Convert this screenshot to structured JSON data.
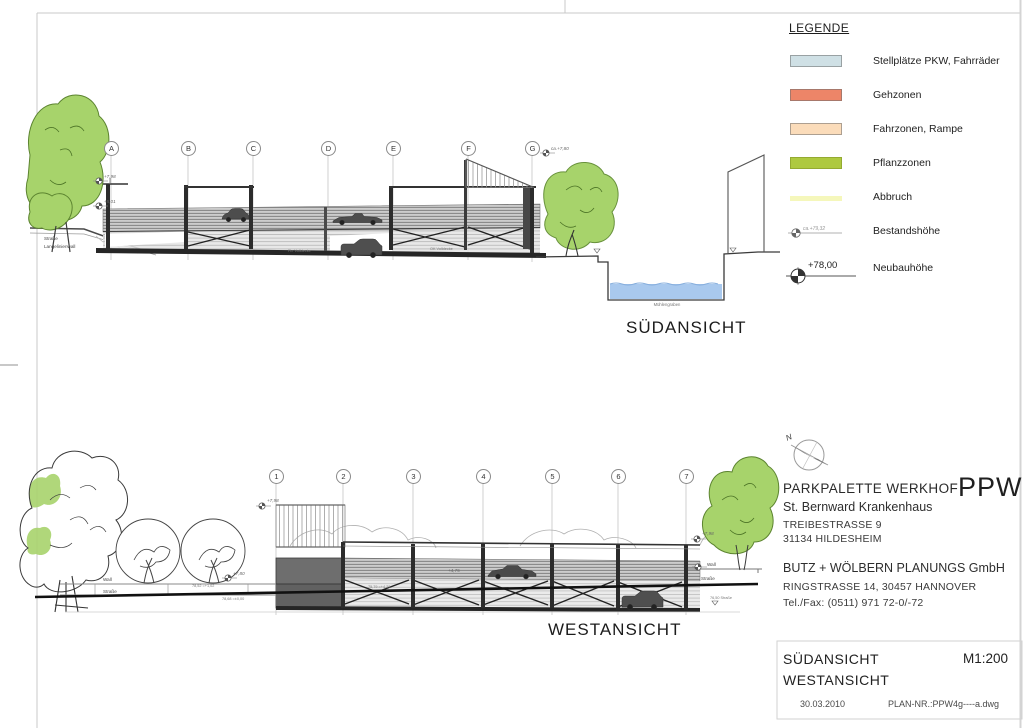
{
  "legend": {
    "title": "LEGENDE",
    "items": [
      {
        "label": "Stellplätze PKW, Fahrräder",
        "color": "#cfe0e5"
      },
      {
        "label": "Gehzonen",
        "color": "#ed8568"
      },
      {
        "label": "Fahrzonen, Rampe",
        "color": "#fbdcba"
      },
      {
        "label": "Pflanzzonen",
        "color": "#aec93f"
      },
      {
        "label": "Abbruch",
        "color": "#f5f7bb"
      },
      {
        "label": "Bestandshöhe",
        "value": "ca.+79,32"
      },
      {
        "label": "Neubauhöhe",
        "value": "+78,00"
      }
    ]
  },
  "titleblock": {
    "north_label": "N",
    "project": "PARKPALETTE WERKHOF",
    "logo": "PPW",
    "client": "St. Bernward Krankenhaus",
    "client_street": "TREIBESTRASSE 9",
    "client_city": "31134 HILDESHEIM",
    "planner": "BUTZ + WÖLBERN PLANUNGS GmbH",
    "planner_street": "RINGSTRASSE 14, 30457 HANNOVER",
    "planner_phone": "Tel./Fax: (0511) 971 72-0/-72",
    "sheet_view1": "SÜDANSICHT",
    "sheet_view2": "WESTANSICHT",
    "scale": "M1:200",
    "date": "30.03.2010",
    "plan_no": "PLAN-NR.:PPW4g----a.dwg"
  },
  "sued": {
    "view_label": "SÜDANSICHT",
    "grid": [
      "A",
      "B",
      "C",
      "D",
      "E",
      "F",
      "G"
    ],
    "road_line1": "Straße",
    "road_line2": "Langelinienwall",
    "water_label": "Mühlengraben",
    "marks": {
      "a_top": "+7,98",
      "a_mid": "+5,01",
      "g_top": "ca.+7,80",
      "note1": "Fb. Volldecke",
      "note2": "OK Volldecke"
    }
  },
  "west": {
    "view_label": "WESTANSICHT",
    "grid": [
      "1",
      "2",
      "3",
      "4",
      "5",
      "6",
      "7"
    ],
    "wall_left": "Wall",
    "street_left": "Straße",
    "wall_right": "Wall",
    "street_right": "Straße",
    "marks": {
      "tower_top": "+7,98",
      "tree": "+7,80",
      "right_top": "+7,98",
      "deck": "+4,75",
      "ramp": "75,79 =+4,29",
      "street_a": "78,52 =+1,02",
      "street_b": "78,68 =±0,00",
      "street_r": "76,50 Straße"
    }
  },
  "colors": {
    "water": "#a9c9ee",
    "tree_green": "#a7d36b",
    "structure_dark": "#2c2c2c"
  }
}
